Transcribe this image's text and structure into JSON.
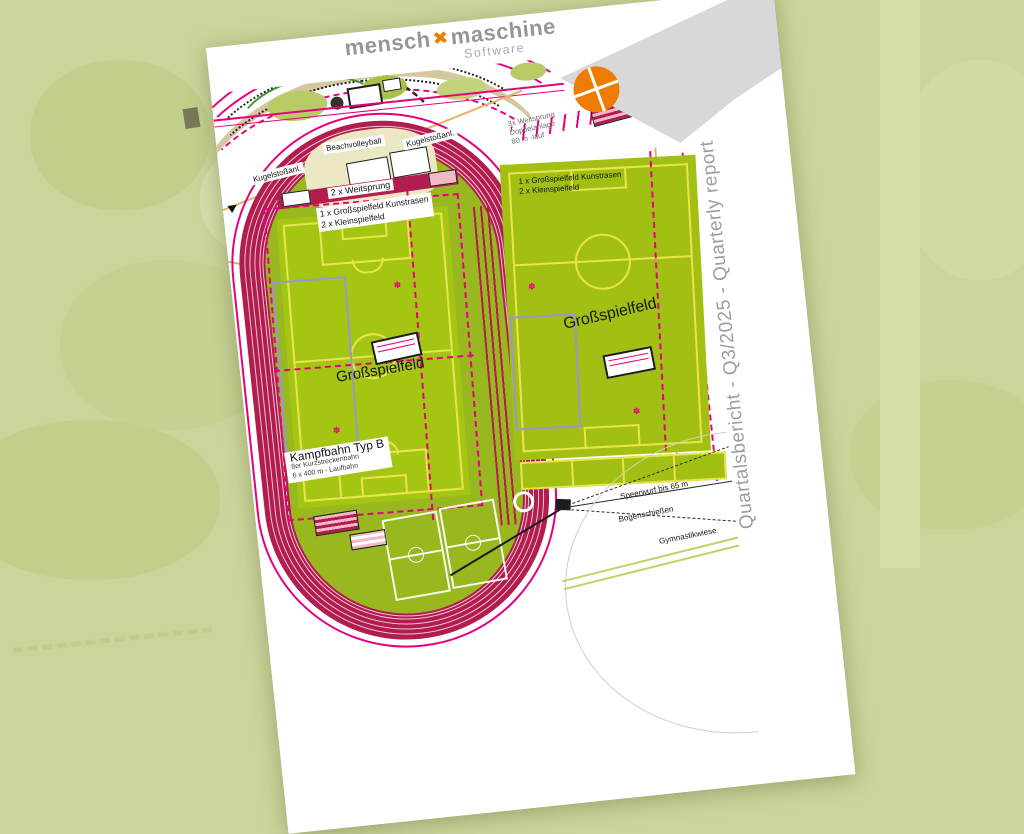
{
  "page": {
    "logo": {
      "word1": "mensch",
      "x_icon": "orange-x-icon",
      "word2": "maschine",
      "subtitle": "Software"
    },
    "vertical_title": "Quartalsbericht - Q3/2025 - Quarterly report"
  },
  "map": {
    "labels": {
      "beachvolleyball": "Beachvolleyball",
      "kugelstoss_left": "Kugelstoßanl.",
      "kugelstoss_right": "Kugelstoßanl.",
      "weitsprung2": "2 x Weitsprung",
      "field1_info_line1": "1 x Großspielfeld Kunstrasen",
      "field1_info_line2": "2 x Kleinspielfeld",
      "field2_info_line1": "1 x Großspielfeld Kunstrasen",
      "field2_info_line2": "2 x Kleinspielfeld",
      "weitsprung3_line1": "3x Weitsprung",
      "weitsprung3_line2": "Doppelanlage",
      "weitsprung3_line3": "80 m -lauf",
      "field1_name": "Großspielfeld",
      "field2_name": "Großspielfeld",
      "kampfbahn_title": "Kampfbahn Typ B",
      "kampfbahn_line2": "8er Kurzstreckenbahn",
      "kampfbahn_line3": "6 x 400 m - Laufbahn",
      "speerwurf": "Speerwurf bis 65 m",
      "bogenschiessen": "Bogenschießen",
      "gymnastikwiese": "Gymnastikwiese"
    }
  },
  "colors": {
    "background_green": "#cbd59a",
    "page_white": "#ffffff",
    "accent_orange": "#ee7c00",
    "gray_band": "#d8d8d8",
    "logo_gray": "#95969a",
    "title_gray": "#9b9da0",
    "track_red": "#b21c4e",
    "field_green": "#a5c513",
    "infield_green": "#99b71f",
    "marking_yellow": "#e9e44e",
    "magenta": "#e5017e",
    "utility_tan": "#e2b566",
    "purple_line": "#9a96d2"
  }
}
